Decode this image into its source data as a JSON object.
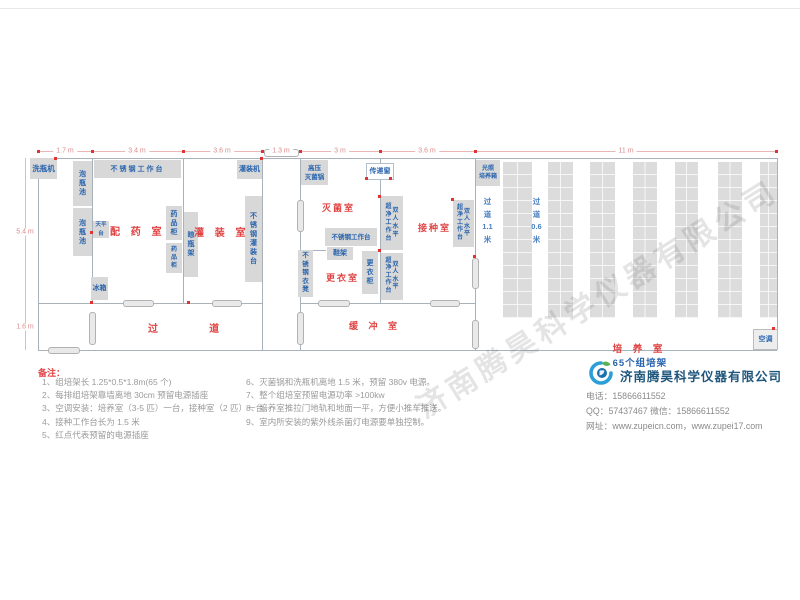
{
  "watermark": "济南腾昊科学仪器有限公司",
  "dims": {
    "top1": "1.7 m",
    "top2": "3.4 m",
    "top3": "3.6 m",
    "top4": "1.3 m",
    "top5": "3 m",
    "top6": "3.6 m",
    "top7": "11 m",
    "left1": "5.4 m",
    "left2": "1.6 m"
  },
  "rooms": {
    "peiyao": "配 药 室",
    "guanzhuang": "灌 装 室",
    "guodao": "过    道",
    "miejun": "灭菌室",
    "jiezhong": "接种室",
    "gengyi": "更衣室",
    "huanchong": "缓 冲 室",
    "peiyang": "培 养 室",
    "peiyang_count": "65个组培架"
  },
  "corridors": {
    "c11": "过\n道\n1.1\n米",
    "c06": "过\n道\n0.6\n米"
  },
  "equipment": {
    "washer": "洗瓶机",
    "pool": "泡\n瓶\n池",
    "worktable": "不锈钢工作台",
    "balance": "天平台",
    "med_cabinet": "药\n品\n柜",
    "bottle_rack": "晾\n瓶\n架",
    "fridge": "冰箱",
    "filler": "灌装机",
    "fill_table": "不\n锈\n钢\n灌\n装\n台",
    "autoclave": "高压\n灭菌锅",
    "pass_window": "传递窗",
    "shoe_rack": "鞋架",
    "bench": "不\n锈\n钢\n衣\n凳",
    "locker": "更\n衣\n柜",
    "clean_left": "超\n净\n工\n作\n台",
    "clean_right": "双\n人\n水\n平",
    "incubator": "光照\n培养箱",
    "ac": "空调"
  },
  "notes": {
    "title": "备注：",
    "col1": [
      "1、组培架长 1.25*0.5*1.8m(65 个)",
      "2、每排组培架靠墙离地 30cm 预留电源插座",
      "3、空调安装：培养室（3-5 匹）一台，接种室（2 匹）一台。",
      "4、接种工作台长为 1.5 米",
      "5、红点代表预留的电源插座"
    ],
    "col2": [
      "6、灭菌锅和洗瓶机离地 1.5 米，预留 380v 电源。",
      "7、整个组培室预留电源功率 >100kw",
      "8、培养室推拉门地轨和地面一平，方便小推车推送。",
      "9、室内所安装的紫外线杀菌灯电源要单独控制。"
    ]
  },
  "company": {
    "name": "济南腾昊科学仪器有限公司",
    "phone_line": "电话：15866611552",
    "qq_line": "QQ：57437467   微信：15866611552",
    "web_line": "网址：www.zupeicn.com，www.zupei17.com"
  }
}
